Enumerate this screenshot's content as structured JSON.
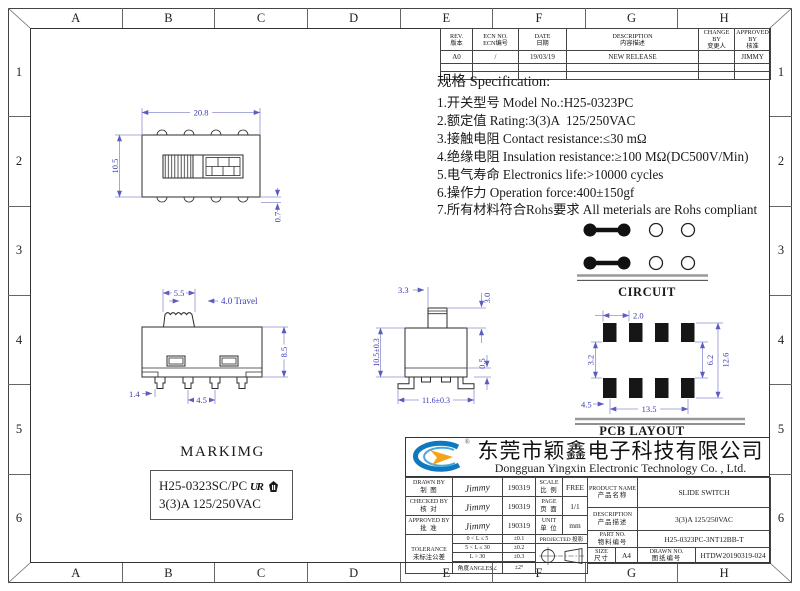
{
  "frame": {
    "cols": [
      "A",
      "B",
      "C",
      "D",
      "E",
      "F",
      "G",
      "H"
    ],
    "rows": [
      "1",
      "2",
      "3",
      "4",
      "5",
      "6"
    ]
  },
  "revision": {
    "headers": [
      {
        "en": "REV.",
        "cn": "版本"
      },
      {
        "en": "ECN NO.",
        "cn": "ECN编号"
      },
      {
        "en": "DATE",
        "cn": "日期"
      },
      {
        "en": "DESCRIPTION",
        "cn": "内容描述"
      },
      {
        "en": "CHANGE BY",
        "cn": "变更人"
      },
      {
        "en": "APPROVED BY",
        "cn": "核准"
      }
    ],
    "row": {
      "rev": "A0",
      "ecn": "/",
      "date": "19/03/19",
      "desc": "NEW RELEASE",
      "change": "",
      "approve": "JIMMY"
    }
  },
  "spec": {
    "title": "规格 Specification:",
    "items": [
      "1.开关型号 Model No.:H25-0323PC",
      "2.额定值 Rating:3(3)A  125/250VAC",
      "3.接触电阻 Contact resistance:≤30 mΩ",
      "4.绝缘电阻 Insulation resistance:≥100 MΩ(DC500V/Min)",
      "5.电气寿命 Electronics life:>10000 cycles",
      "6.操作力 Operation force:400±150gf",
      "7.所有材料符合Rohs要求 All meterials are Rohs compliant"
    ]
  },
  "dims": {
    "top_w": "20.8",
    "top_h": "10.5",
    "top_bump": "0.7",
    "front_knob": "5.5",
    "front_travel": "4.0 Travel",
    "front_h": "8.5",
    "front_pin": "1.4",
    "front_pitch": "4.5",
    "side_act_w": "3.3",
    "side_act_h": "3.0",
    "side_h": "10.5±0.3",
    "side_foot": "0.5",
    "side_w": "11.6±0.3",
    "pcb_pitch": "2.0",
    "pcb_gap": "3.2",
    "pcb_inner": "6.2",
    "pcb_outer": "12.6",
    "pcb_offset": "4.5",
    "pcb_span": "13.5"
  },
  "circuit": {
    "label": "CIRCUIT"
  },
  "pcb": {
    "label": "PCB LAYOUT"
  },
  "marking": {
    "title": "MARKIMG",
    "line1": "H25-0323SC/PC",
    "line2": "3(3)A  125/250VAC",
    "ul_mark": "UR"
  },
  "company": {
    "name_cn": "东莞市颖鑫电子科技有限公司",
    "name_en": "Dongguan Yingxin Electronic Technology Co. , Ltd.",
    "reg": "®"
  },
  "title_block": {
    "drawn_by": {
      "en": "DRAWN BY",
      "cn": "制 图",
      "sig": "Jimmy",
      "date": "190319"
    },
    "checked_by": {
      "en": "CHECKED BY",
      "cn": "核 对",
      "sig": "Jimmy",
      "date": "190319"
    },
    "approved_by": {
      "en": "APPROVED BY",
      "cn": "批 准",
      "sig": "Jimmy",
      "date": "190319"
    },
    "scale": {
      "en": "SCALE",
      "cn": "比 例",
      "value": "FREE"
    },
    "page": {
      "en": "PAGE",
      "cn": "页 面",
      "value": "1/1"
    },
    "unit": {
      "en": "UNIT",
      "cn": "单 位",
      "value": "mm"
    },
    "tolerance": {
      "en": "TOLERANCE",
      "cn": "未标注公差",
      "rows": [
        {
          "range": "0 < L ≤ 5",
          "tol": "±0.1"
        },
        {
          "range": "5 < L ≤ 30",
          "tol": "±0.2"
        },
        {
          "range": "L > 30",
          "tol": "±0.3"
        },
        {
          "range": "角度ANGLES∠",
          "tol": "±2°"
        }
      ]
    },
    "projected": {
      "en": "PROJECTED",
      "cn": "投影"
    },
    "product_name": {
      "en": "PRODUCT NAME",
      "cn": "产品名称",
      "value": "SLIDE SWITCH"
    },
    "description": {
      "en": "DESCRIPTION",
      "cn": "产品描述",
      "value": "3(3)A  125/250VAC"
    },
    "part_no": {
      "en": "PART NO.",
      "cn": "物料编号",
      "value": "H25-0323PC-3NT12BB-T"
    },
    "size": {
      "en": "SIZE",
      "cn": "尺寸",
      "value": "A4"
    },
    "drawn_no": {
      "en": "DRAWN NO.",
      "cn": "图纸编号",
      "value": "HTDW20190319-024"
    }
  }
}
